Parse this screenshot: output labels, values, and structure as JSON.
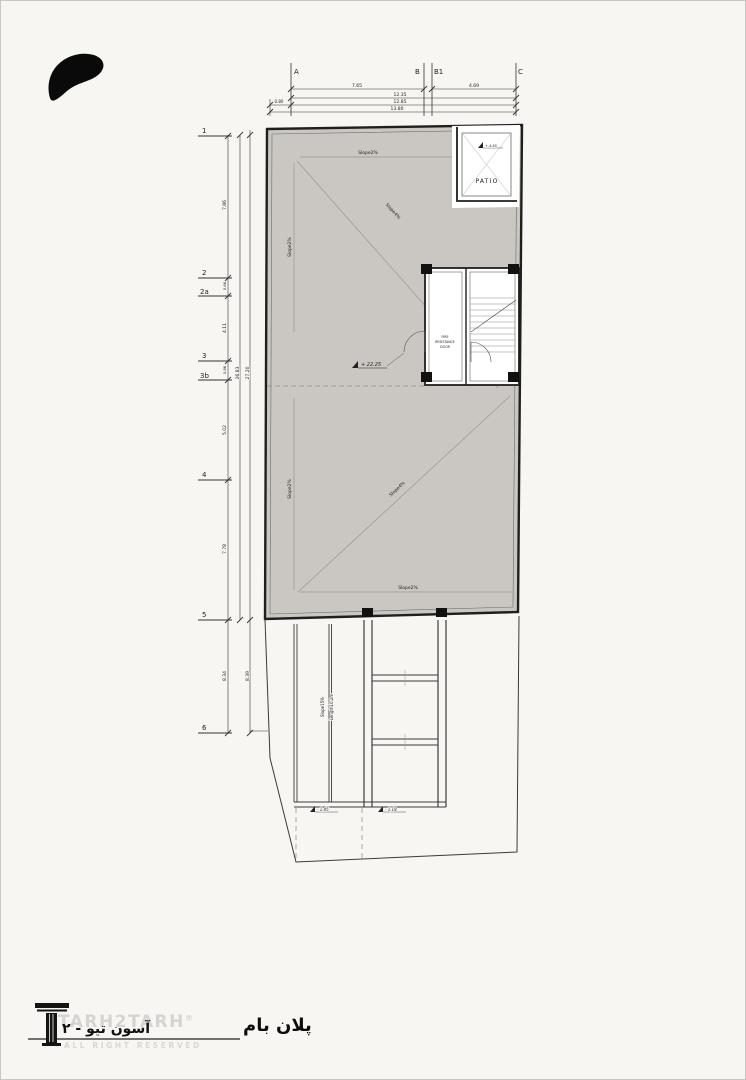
{
  "grid": {
    "cols": {
      "a": "A",
      "b": "B",
      "b1": "B1",
      "c": "C"
    },
    "rows": {
      "r1": "1",
      "r2": "2",
      "r2a": "2a",
      "r3": "3",
      "r3b": "3b",
      "r4": "4",
      "r5": "5",
      "r6": "6"
    }
  },
  "dims": {
    "top_ab": "7.65",
    "top_b1c": "4.69",
    "top_1235": "12.35",
    "top_080": "0.80",
    "top_1285": "12.85",
    "top_1380": "13.80",
    "left_12": "7.86",
    "left_22a": "0.66",
    "left_2a3": "4.11",
    "left_33b": "0.86",
    "left_3b4": "5.02",
    "left_45": "7.78",
    "left_56": "8.34",
    "left_total_a": "26.83",
    "left_total_b": "27.20",
    "left_56_outer": "8.39"
  },
  "labels": {
    "patio": "PATIO",
    "patio_level": "+ 4.85",
    "roof_level": "+ 22.25",
    "fire_door_1": "FIRE",
    "fire_door_2": "RESISTANCE",
    "fire_door_3": "DOOR",
    "slope2": "Slope2%",
    "slope4": "Slope4%",
    "ramp_slope": "Slope15%",
    "ramp_length": "Length10.2m",
    "level_ramp": "- 1.45",
    "level_yard": "- 1.18"
  },
  "titleblock": {
    "title": "پلان بام",
    "brand": "TARH2TARH",
    "brand_reg": "®",
    "brand_sub": "ALL RIGHT RESERVED",
    "brand_overlay": "آسون تیو - ۲"
  },
  "colors": {
    "roof_fill": "#cac7c2",
    "paper": "#f7f6f3",
    "line": "#222222"
  }
}
